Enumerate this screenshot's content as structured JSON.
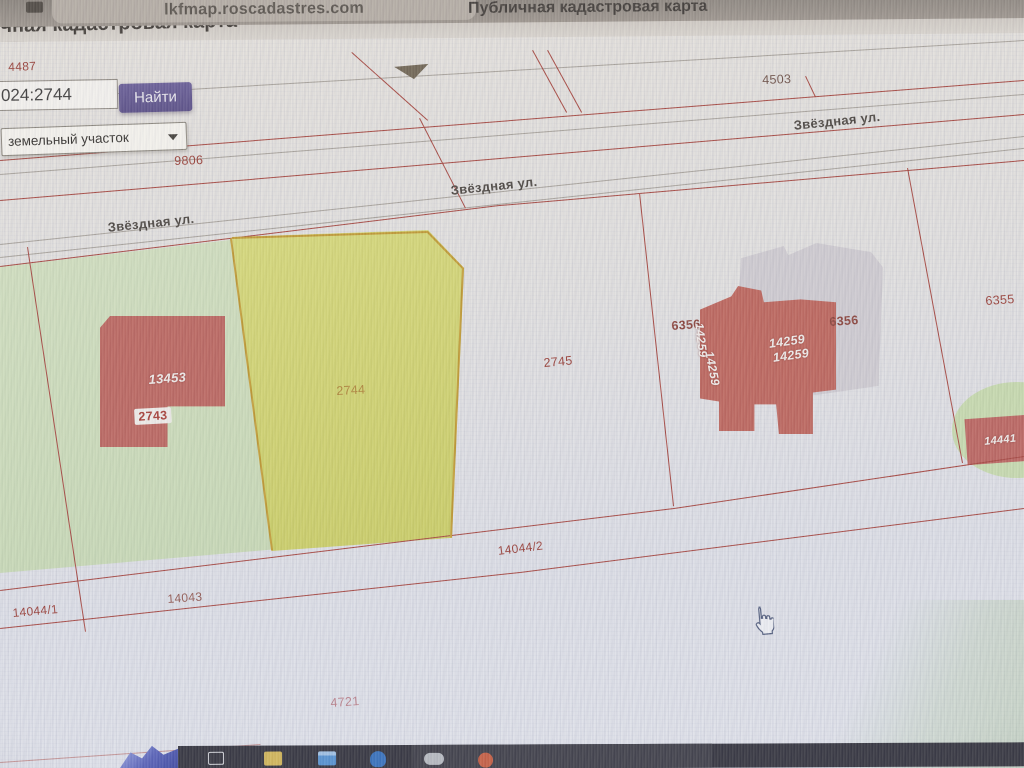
{
  "browser": {
    "url": "lkfmap.roscadastres.com",
    "title": "Публичная кадастровая карта",
    "page_header": "Публичная кадастровая карта"
  },
  "search": {
    "query": "024:2744",
    "find_button": "Найти",
    "object_type": "земельный участок"
  },
  "map": {
    "street_name": "Звёздная ул.",
    "labels": {
      "p4487": "4487",
      "p4503": "4503",
      "p9806": "9806",
      "p2743": "2743",
      "p2744": "2744",
      "p2745": "2745",
      "p6356": "6356",
      "p6355": "6355",
      "p14044_1": "14044/1",
      "p14043": "14043",
      "p14044_2": "14044/2",
      "p4721": "4721",
      "b13453": "13453",
      "b14259": "14259",
      "b14441": "14441"
    }
  },
  "taskbar": {
    "icons": [
      "apps-icon",
      "folder-icon",
      "photos-icon",
      "drive-icon",
      "cloud-icon",
      "browser-icon"
    ]
  },
  "colors": {
    "boundary_red": "#ad4038",
    "selected_parcel_yellow": "#d7da5e",
    "building_red": "#c4625c",
    "parcel_green": "#cfe2ba",
    "accent_purple": "#5a4f91"
  },
  "cursor": {
    "type": "hand-pointer"
  }
}
